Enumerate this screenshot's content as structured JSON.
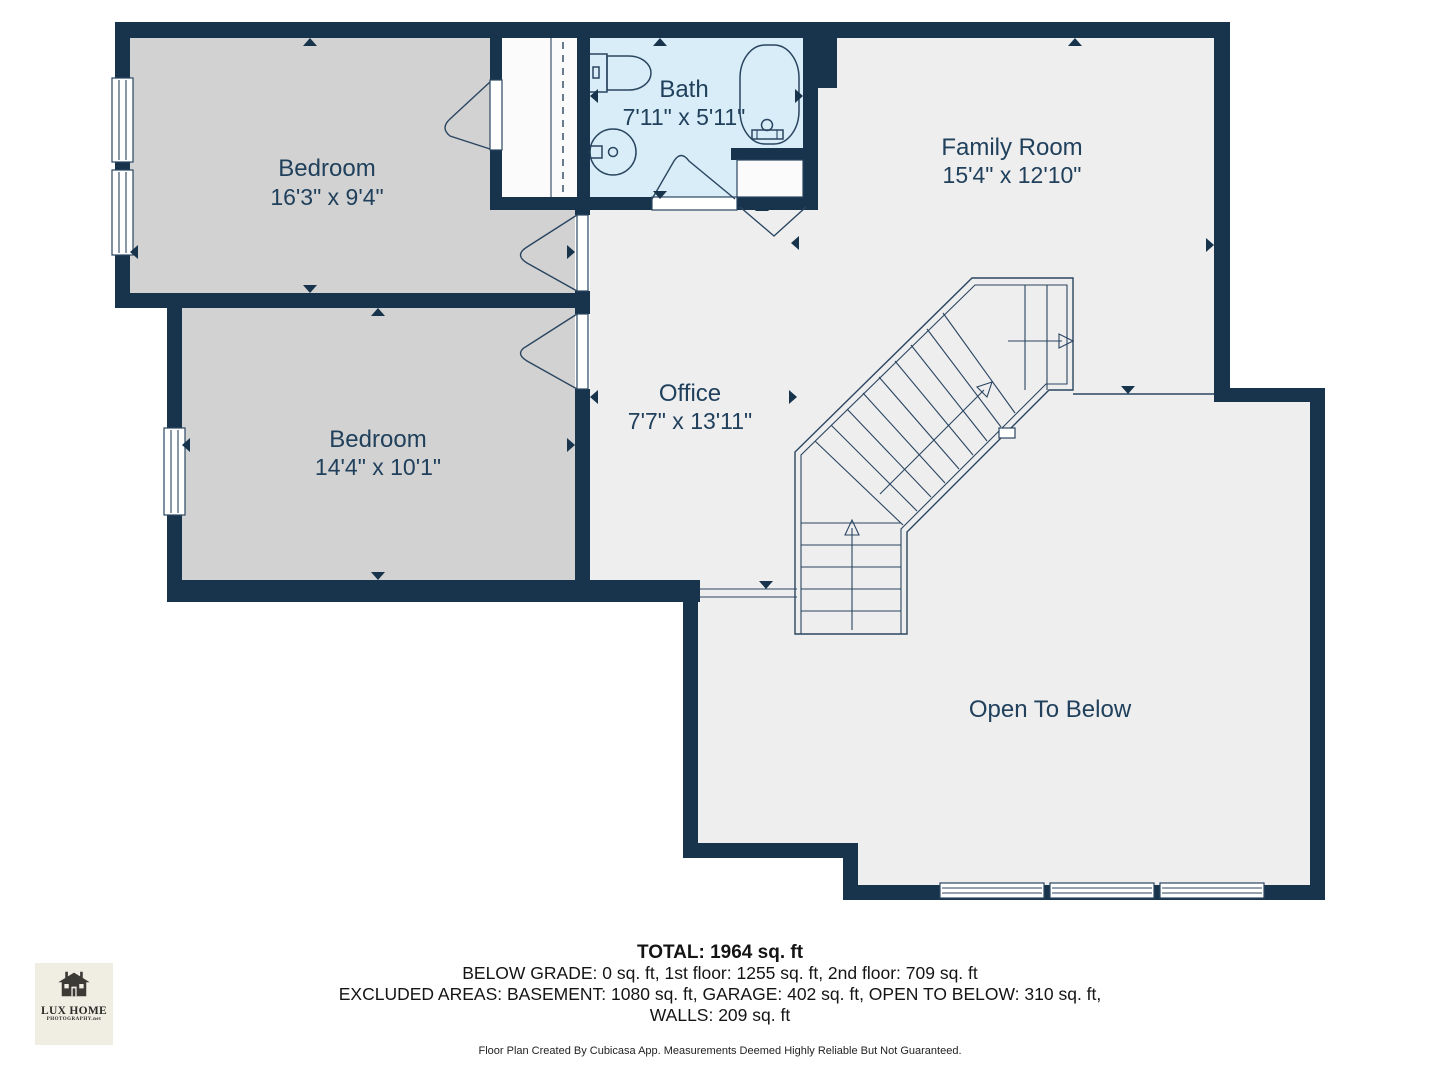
{
  "plan": {
    "rooms": [
      {
        "id": "bedroom-1",
        "name": "Bedroom",
        "dims": "16'3\" x 9'4\""
      },
      {
        "id": "bath",
        "name": "Bath",
        "dims": "7'11\" x 5'11\""
      },
      {
        "id": "family-room",
        "name": "Family Room",
        "dims": "15'4\" x 12'10\""
      },
      {
        "id": "bedroom-2",
        "name": "Bedroom",
        "dims": "14'4\" x 10'1\""
      },
      {
        "id": "office",
        "name": "Office",
        "dims": "7'7\" x 13'11\""
      },
      {
        "id": "open-to-below",
        "name": "Open To Below",
        "dims": ""
      }
    ]
  },
  "summary": {
    "total": "TOTAL: 1964 sq. ft",
    "line1": "BELOW GRADE: 0 sq. ft, 1st floor: 1255 sq. ft, 2nd floor: 709 sq. ft",
    "line2": "EXCLUDED AREAS: BASEMENT: 1080 sq. ft, GARAGE: 402 sq. ft, OPEN TO BELOW: 310 sq. ft,",
    "line3": "WALLS: 209 sq. ft",
    "disclaimer": "Floor Plan Created By Cubicasa App. Measurements Deemed Highly Reliable But Not Guaranteed."
  },
  "logo": {
    "title": "LUX HOME",
    "subtitle": "PHOTOGRAPHY.net"
  },
  "colors": {
    "wall": "#17344c",
    "bedroom_floor": "#d2d2d2",
    "bath_floor": "#d9edf8",
    "main_floor": "#eeeeef",
    "closet_floor": "#fbfbfb",
    "label": "#20405c",
    "logo_bg": "#f0ede3"
  }
}
